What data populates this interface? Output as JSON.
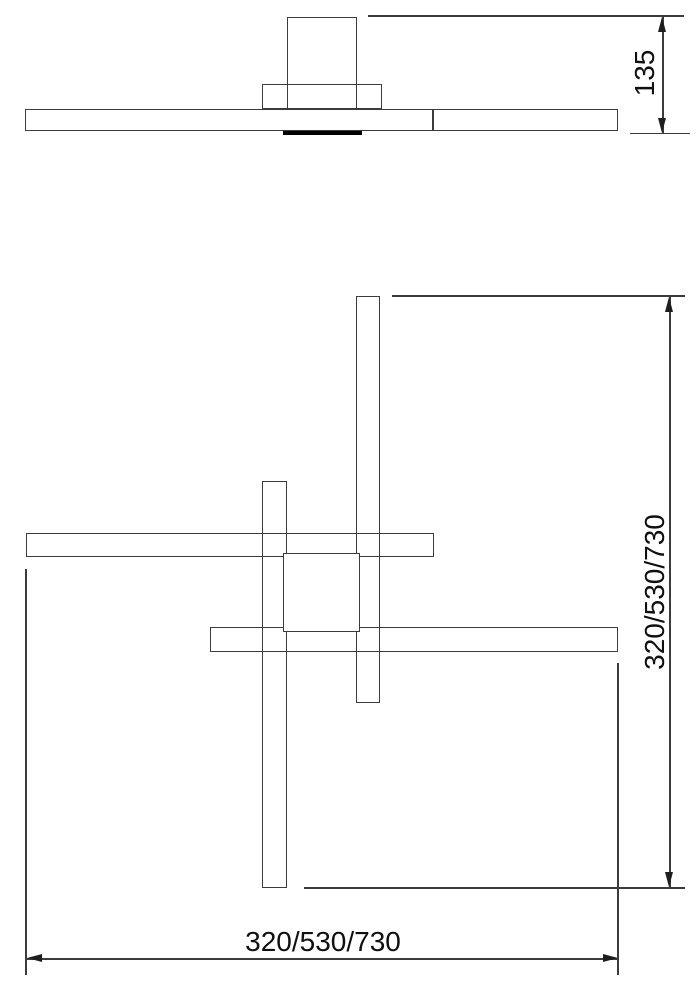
{
  "drawing": {
    "side_view": {
      "height_dimension": "135"
    },
    "plan_view": {
      "height_dimension": "320/530/730",
      "width_dimension": "320/530/730"
    },
    "colors": {
      "outline": "#3c3c3c",
      "accent_strip": "#000000",
      "text": "#0f0f0f",
      "background": "#ffffff"
    }
  }
}
